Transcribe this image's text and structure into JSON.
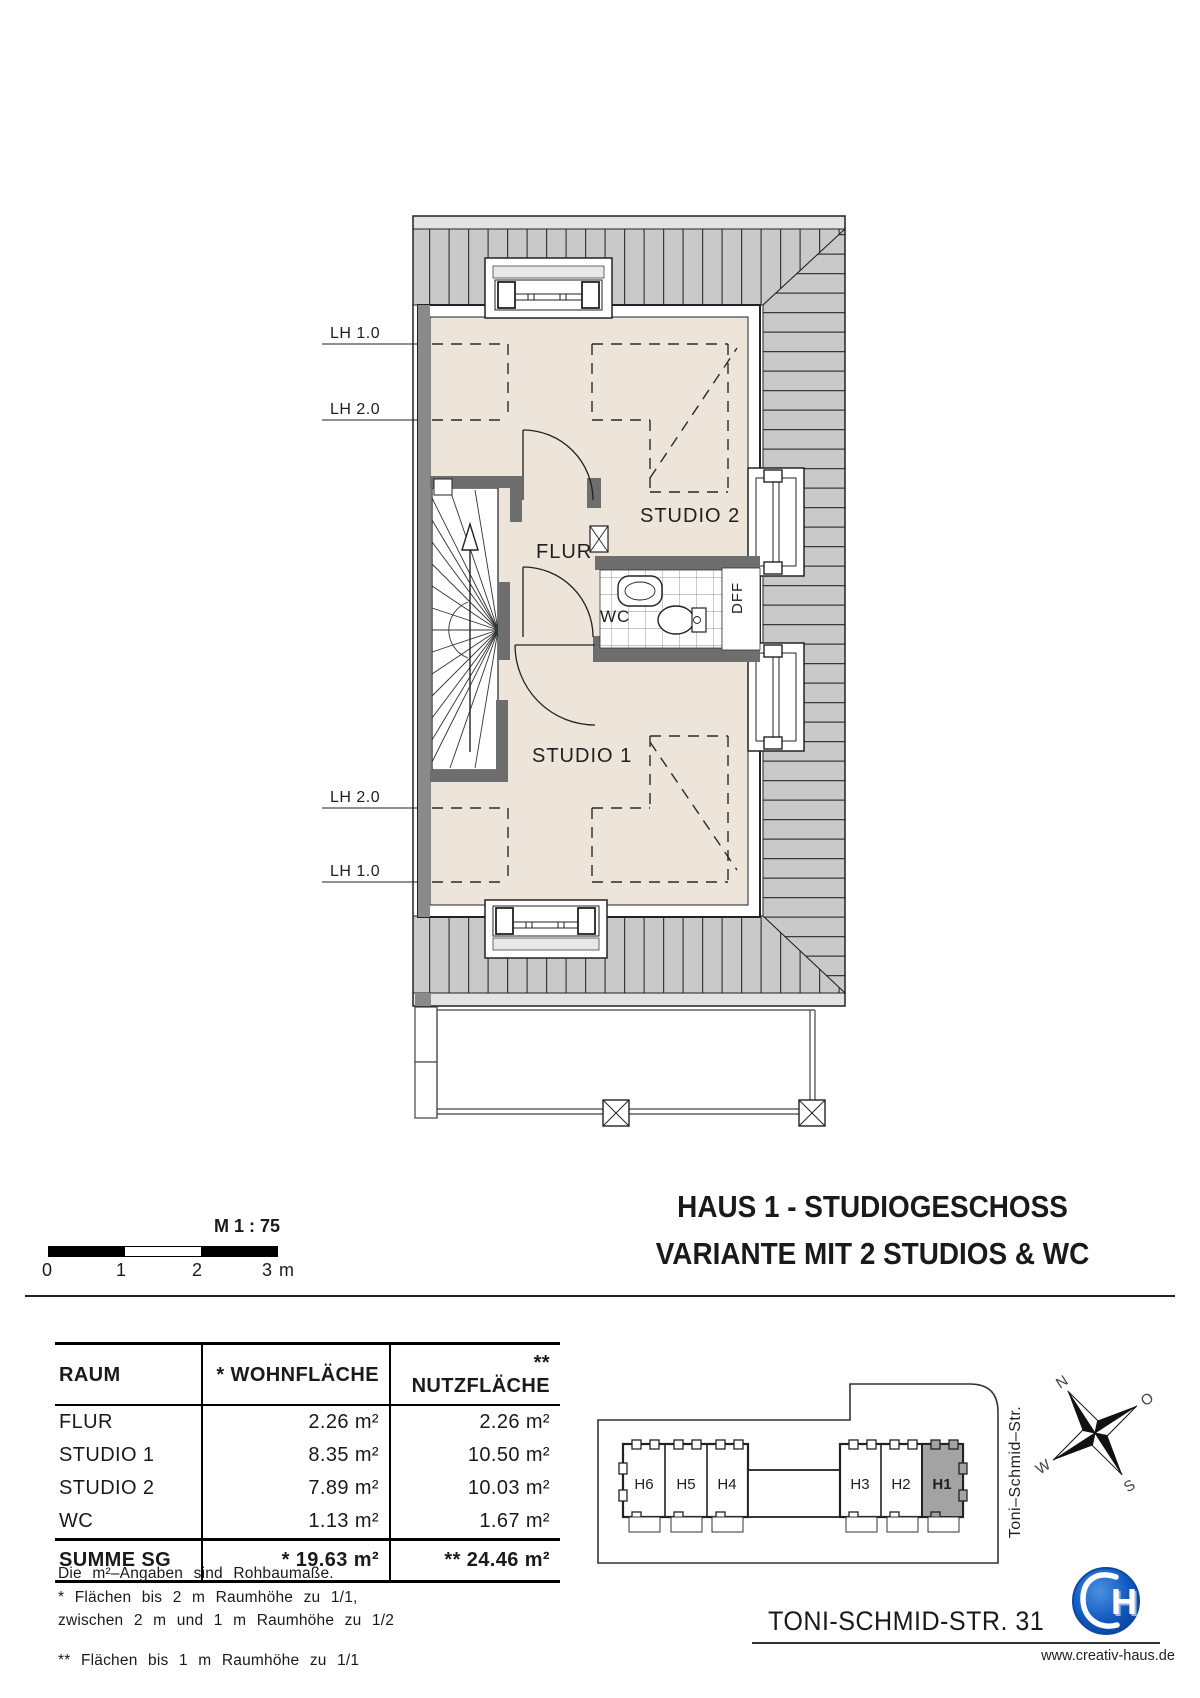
{
  "plan": {
    "rooms": {
      "studio2": "STUDIO 2",
      "studio1": "STUDIO 1",
      "flur": "FLUR",
      "wc": "WC",
      "dff": "DFF"
    },
    "lh_top_1": "LH 1.0",
    "lh_top_2": "LH 2.0",
    "lh_bottom_2": "LH 2.0",
    "lh_bottom_1": "LH 1.0"
  },
  "title": {
    "line1": "HAUS 1 - STUDIOGESCHOSS",
    "line2": "VARIANTE MIT 2 STUDIOS & WC"
  },
  "scalebar": {
    "label": "M 1 : 75",
    "tick0": "0",
    "tick1": "1",
    "tick2": "2",
    "tick3": "3 m"
  },
  "table": {
    "headers": [
      "RAUM",
      "* WOHNFLÄCHE",
      "** NUTZFLÄCHE"
    ],
    "rows": [
      [
        "FLUR",
        "2.26 m²",
        "2.26 m²"
      ],
      [
        "STUDIO 1",
        "8.35 m²",
        "10.50 m²"
      ],
      [
        "STUDIO 2",
        "7.89 m²",
        "10.03 m²"
      ],
      [
        "WC",
        "1.13 m²",
        "1.67 m²"
      ]
    ],
    "summary": [
      "SUMME SG",
      "* 19.63 m²",
      "** 24.46 m²"
    ]
  },
  "footnotes": {
    "l1": "Die m²–Angaben sind Rohbaumaße.",
    "l2": "* Flächen bis 2 m Raumhöhe zu 1/1,",
    "l3": "zwischen 2 m und 1 m Raumhöhe zu 1/2",
    "l4": "** Flächen bis 1 m Raumhöhe zu 1/1"
  },
  "siteplan": {
    "houses": [
      "H6",
      "H5",
      "H4",
      "H3",
      "H2",
      "H1"
    ],
    "highlighted": "H1",
    "street": "Toni–Schmid–Str.",
    "compass": {
      "n": "N",
      "e": "O",
      "s": "S",
      "w": "W"
    }
  },
  "address": "TONI-SCHMID-STR. 31",
  "branding": {
    "url": "www.creativ-haus.de"
  },
  "colors": {
    "roof_gray": "#c9c9c9",
    "floor_beige": "#ede4da",
    "wall_gray": "#6e6e6e",
    "highlight_gray": "#a3a3a3",
    "logo_blue": "#1160c8"
  }
}
